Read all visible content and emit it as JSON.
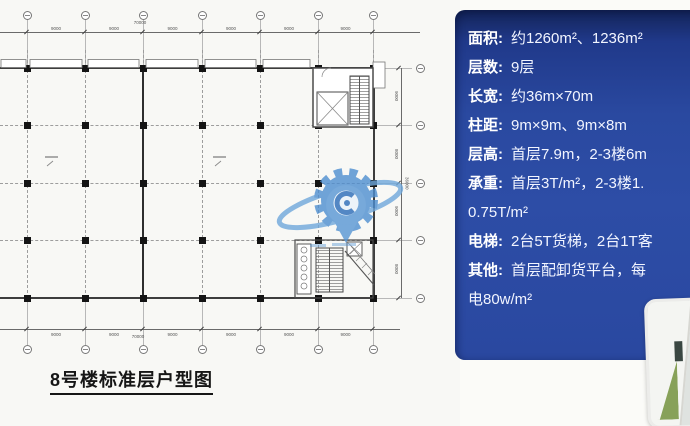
{
  "plan": {
    "title": "8号楼标准层户型图",
    "grid_x": [
      27,
      85,
      143,
      202,
      260,
      318,
      373
    ],
    "grid_y": [
      68,
      125,
      183,
      240,
      298
    ],
    "dim_h_labels": [
      "9000",
      "9000",
      "9000",
      "9000",
      "9000",
      "9000"
    ],
    "dim_h_total": "70000",
    "dim_v_labels": [
      "9000",
      "8000",
      "9000",
      "8000"
    ],
    "dim_v_total": "36000"
  },
  "panel": {
    "bg_color": "#2a49a0",
    "text_color": "#ffffff",
    "rows": [
      {
        "label": "面积:",
        "lines": [
          "约1260m²、1236m²"
        ]
      },
      {
        "label": "层数:",
        "lines": [
          "9层"
        ]
      },
      {
        "label": "长宽:",
        "lines": [
          "约36m×70m"
        ]
      },
      {
        "label": "柱距:",
        "lines": [
          "9m×9m、9m×8m"
        ]
      },
      {
        "label": "层高:",
        "lines": [
          "首层7.9m，2-3楼6m"
        ]
      },
      {
        "label": "承重:",
        "lines": [
          "首层3T/m²，2-3楼1.",
          "0.75T/m²"
        ]
      },
      {
        "label": "电梯:",
        "lines": [
          "2台5T货梯，2台1T客"
        ]
      },
      {
        "label": "其他:",
        "lines": [
          "首层配卸货平台，每",
          "电80w/m²"
        ]
      }
    ]
  },
  "icons": {
    "watermark": "gear-location-pin-logo",
    "watermark_color": "#4e8ed0"
  },
  "photo": {
    "name": "building-aerial-render-thumbnail"
  }
}
